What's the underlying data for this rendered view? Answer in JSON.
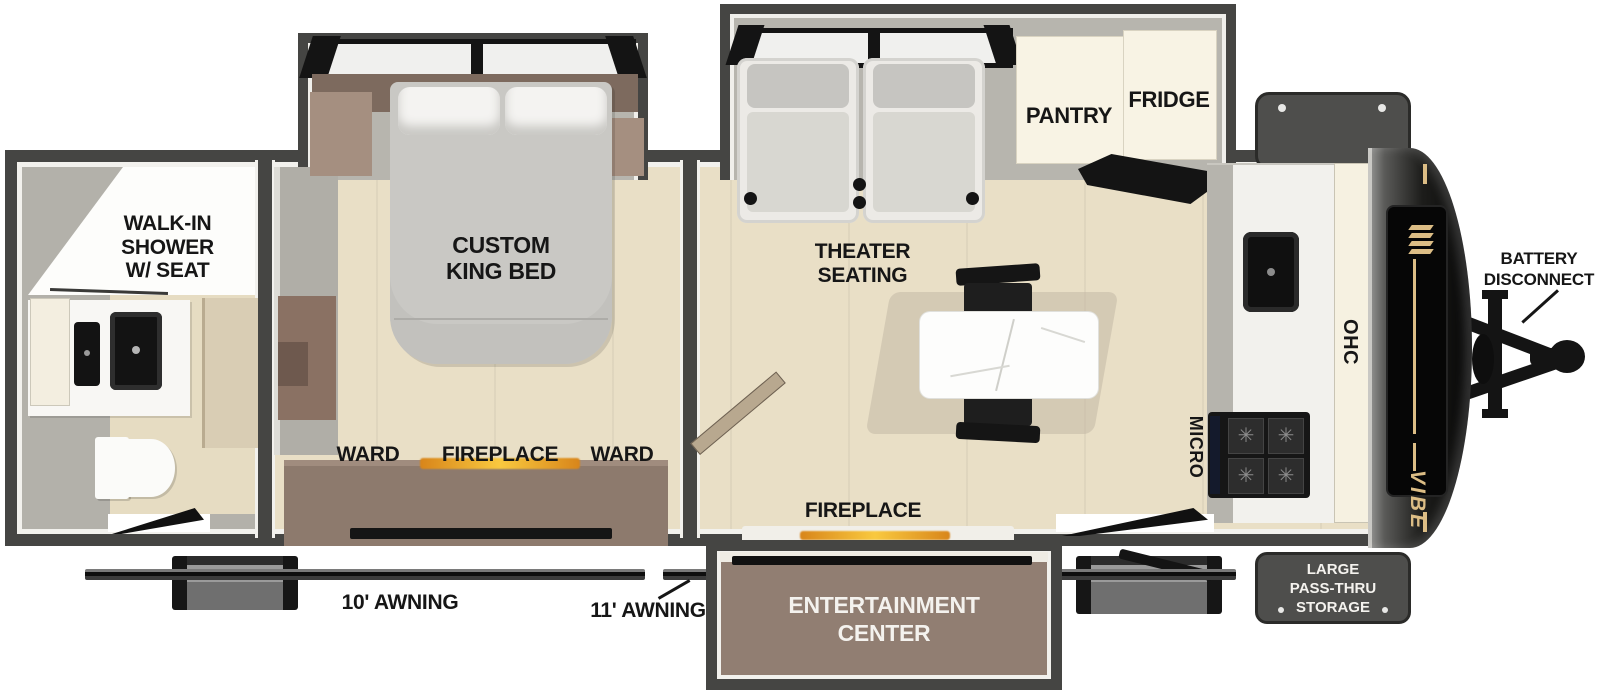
{
  "palette": {
    "wall_dark": "#454543",
    "floor_beige": "#e9dfc6",
    "slide_gray": "#b7b5ae",
    "furniture_brown": "#8d7a6d",
    "cabinet_cream": "#f8f3e4",
    "accent_gold": "#dcbd85",
    "fireplace_orange": "#f9c93f",
    "label_black": "#161616",
    "label_white": "#f4f2ee"
  },
  "rooms": {
    "bathroom": {
      "label_lines": [
        "WALK-IN",
        "SHOWER",
        "W/ SEAT"
      ]
    },
    "bedroom": {
      "bed_lines": [
        "CUSTOM",
        "KING BED"
      ],
      "ward_left": "WARD",
      "fireplace": "FIREPLACE",
      "ward_right": "WARD"
    },
    "living": {
      "theater_lines": [
        "THEATER",
        "SEATING"
      ],
      "pantry": "PANTRY",
      "fridge": "FRIDGE",
      "fireplace": "FIREPLACE",
      "micro": "MICRO",
      "ohc": "OHC"
    },
    "entertainment": {
      "lines": [
        "ENTERTAINMENT",
        "CENTER"
      ]
    }
  },
  "exterior": {
    "storage_lines": [
      "LARGE",
      "PASS-THRU",
      "STORAGE"
    ],
    "battery_lines": [
      "BATTERY",
      "DISCONNECT"
    ],
    "awning_left": "10' AWNING",
    "awning_right": "11' AWNING",
    "brand": "VIBE"
  }
}
